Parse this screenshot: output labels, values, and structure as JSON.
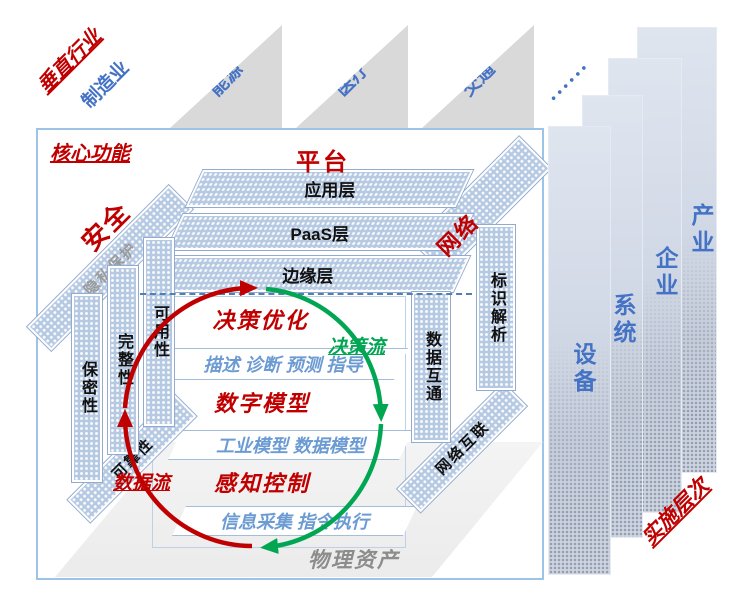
{
  "palette": {
    "red": "#C00000",
    "blue": "#4472C4",
    "green": "#00A651",
    "detail_blue": "#6B9BD2",
    "surface_blue": "#B6C9E2",
    "gray_text": "#8C8C8C"
  },
  "vertical_industries": {
    "title": "垂直行业",
    "primary": "制造业",
    "sectors": [
      "能源",
      "医疗",
      "交通"
    ],
    "more_dots": "••••••"
  },
  "core": {
    "title": "核心功能",
    "platform": {
      "label": "平台",
      "layers": [
        "应用层",
        "PaaS层",
        "边缘层"
      ]
    },
    "security": {
      "label": "安全",
      "privacy": "隐私保护",
      "columns": [
        "保密性",
        "完整性",
        "可用性"
      ],
      "reliability": "可靠性"
    },
    "network": {
      "label": "网络",
      "columns": [
        "标识解析",
        "数据互通"
      ],
      "interconnect": "网络互联"
    },
    "loops": {
      "decision_flow": "决策流",
      "data_flow": "数据流"
    },
    "functions": [
      {
        "title": "决策优化",
        "detail": "描述 诊断 预测 指导"
      },
      {
        "title": "数字模型",
        "detail": "工业模型  数据模型"
      },
      {
        "title": "感知控制",
        "detail": "信息采集 指令执行"
      }
    ],
    "physical_asset": "物理资产"
  },
  "implementation": {
    "title": "实施层次",
    "levels": [
      "设备",
      "系统",
      "企业",
      "产业"
    ]
  }
}
